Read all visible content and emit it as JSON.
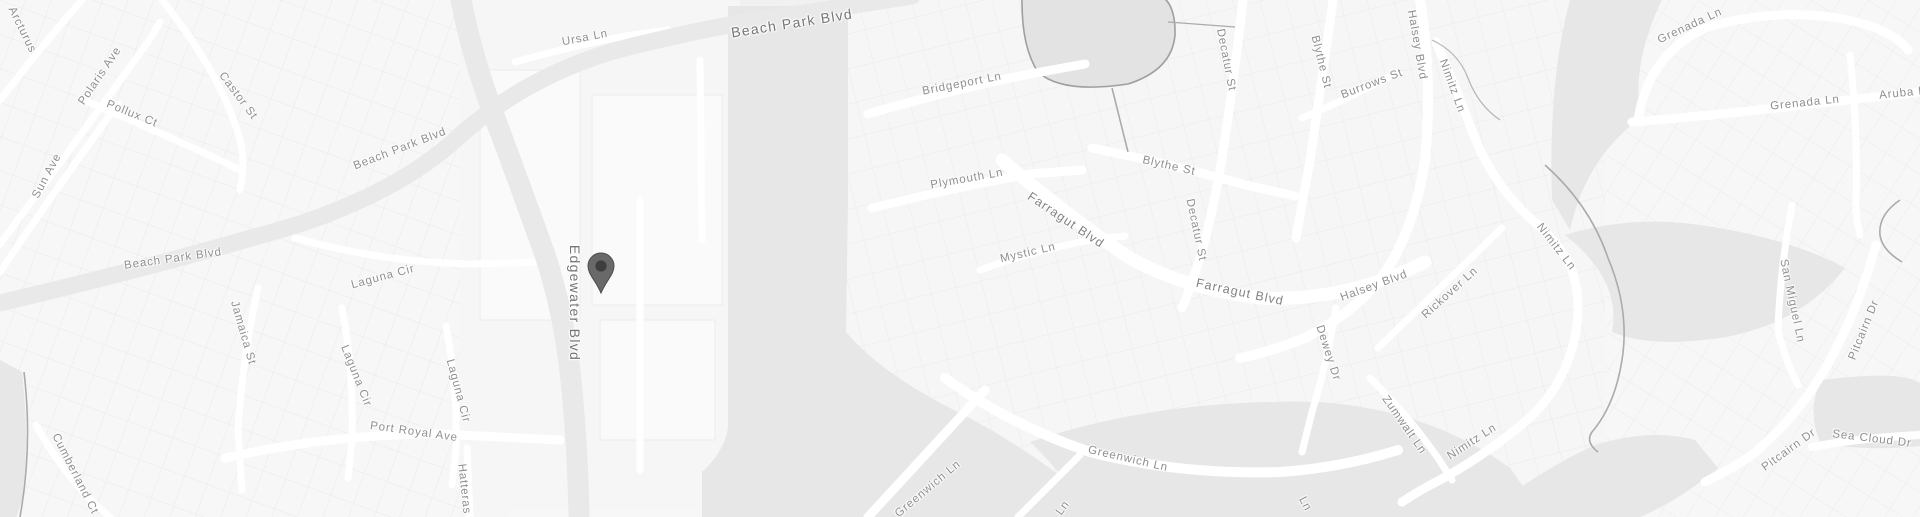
{
  "map": {
    "title": "Grayscale street map with location marker",
    "colors": {
      "land": "#f1f1f2",
      "parcel_fill": "#f8f8f9",
      "parcel_line": "#e9e9ea",
      "road_minor": "#ffffff",
      "road_major": "#e9e9ea",
      "water": "#e7e7e8",
      "pond": "#e3e3e4",
      "coastline": "#a9a9a9",
      "label": "#8f8f8f",
      "label_major": "#757575",
      "pin_body": "#696969",
      "pin_core": "#3e3e3e"
    },
    "pin": {
      "label": "dropped-pin",
      "tip_x": 601,
      "tip_y": 293
    },
    "labels": [
      {
        "text": "Arcturus",
        "x": 22,
        "y": 30,
        "rot": 64,
        "size": "sm"
      },
      {
        "text": "Polaris Ave",
        "x": 100,
        "y": 76,
        "rot": -56,
        "size": "sm"
      },
      {
        "text": "Pollux Ct",
        "x": 132,
        "y": 114,
        "rot": 22,
        "size": "sm"
      },
      {
        "text": "Castor St",
        "x": 238,
        "y": 96,
        "rot": 53,
        "size": "sm"
      },
      {
        "text": "Sun Ave",
        "x": 47,
        "y": 176,
        "rot": -62,
        "size": "sm"
      },
      {
        "text": "Beach Park Blvd",
        "x": 400,
        "y": 149,
        "rot": -21,
        "size": "sm"
      },
      {
        "text": "Beach Park Blvd",
        "x": 173,
        "y": 259,
        "rot": -8,
        "size": "sm"
      },
      {
        "text": "Beach Park Blvd",
        "x": 792,
        "y": 23,
        "rot": -9,
        "size": "lg"
      },
      {
        "text": "Ursa Ln",
        "x": 585,
        "y": 38,
        "rot": -11,
        "size": "sm"
      },
      {
        "text": "Edgewater Blvd",
        "x": 575,
        "y": 303,
        "rot": 90,
        "size": "lg"
      },
      {
        "text": "Laguna Cir",
        "x": 383,
        "y": 277,
        "rot": -15,
        "size": "sm"
      },
      {
        "text": "Jamaica St",
        "x": 243,
        "y": 333,
        "rot": 74,
        "size": "sm"
      },
      {
        "text": "Laguna Cir",
        "x": 356,
        "y": 376,
        "rot": 68,
        "size": "sm"
      },
      {
        "text": "Laguna Cir",
        "x": 458,
        "y": 391,
        "rot": 75,
        "size": "sm"
      },
      {
        "text": "Port Royal Ave",
        "x": 414,
        "y": 432,
        "rot": 8,
        "size": "sm"
      },
      {
        "text": "Cumberland Ct",
        "x": 75,
        "y": 474,
        "rot": 63,
        "size": "sm"
      },
      {
        "text": "Hatteras",
        "x": 464,
        "y": 489,
        "rot": 84,
        "size": "sm"
      },
      {
        "text": "Bridgeport Ln",
        "x": 962,
        "y": 84,
        "rot": -11,
        "size": "sm"
      },
      {
        "text": "Plymouth Ln",
        "x": 967,
        "y": 179,
        "rot": -10,
        "size": "sm"
      },
      {
        "text": "Blythe St",
        "x": 1169,
        "y": 166,
        "rot": 13,
        "size": "sm"
      },
      {
        "text": "Decatur St",
        "x": 1226,
        "y": 60,
        "rot": 79,
        "size": "sm"
      },
      {
        "text": "Blythe St",
        "x": 1321,
        "y": 62,
        "rot": 76,
        "size": "sm"
      },
      {
        "text": "Burrows St",
        "x": 1372,
        "y": 84,
        "rot": -21,
        "size": "sm"
      },
      {
        "text": "Halsey Blvd",
        "x": 1417,
        "y": 45,
        "rot": 80,
        "size": "sm"
      },
      {
        "text": "Nimitz Ln",
        "x": 1452,
        "y": 86,
        "rot": 70,
        "size": "sm"
      },
      {
        "text": "Farragut Blvd",
        "x": 1066,
        "y": 220,
        "rot": 34,
        "size": "md"
      },
      {
        "text": "Mystic Ln",
        "x": 1028,
        "y": 253,
        "rot": -13,
        "size": "sm"
      },
      {
        "text": "Decatur St",
        "x": 1196,
        "y": 230,
        "rot": 78,
        "size": "sm"
      },
      {
        "text": "Farragut Blvd",
        "x": 1240,
        "y": 292,
        "rot": 12,
        "size": "md"
      },
      {
        "text": "Halsey Blvd",
        "x": 1374,
        "y": 286,
        "rot": -20,
        "size": "sm"
      },
      {
        "text": "Rickover Ln",
        "x": 1450,
        "y": 293,
        "rot": -42,
        "size": "sm"
      },
      {
        "text": "Nimitz Ln",
        "x": 1556,
        "y": 247,
        "rot": 52,
        "size": "sm"
      },
      {
        "text": "Dewey Dr",
        "x": 1328,
        "y": 353,
        "rot": 72,
        "size": "sm"
      },
      {
        "text": "Zumwalt Ln",
        "x": 1404,
        "y": 425,
        "rot": 55,
        "size": "sm"
      },
      {
        "text": "Nimitz Ln",
        "x": 1472,
        "y": 442,
        "rot": -33,
        "size": "sm"
      },
      {
        "text": "Greenwich Ln",
        "x": 1128,
        "y": 459,
        "rot": 13,
        "size": "sm"
      },
      {
        "text": "Greenwich Ln",
        "x": 928,
        "y": 489,
        "rot": -40,
        "size": "sm"
      },
      {
        "text": "Ln",
        "x": 1063,
        "y": 508,
        "rot": -55,
        "size": "sm"
      },
      {
        "text": "Ln",
        "x": 1305,
        "y": 504,
        "rot": 62,
        "size": "sm"
      },
      {
        "text": "Grenada Ln",
        "x": 1690,
        "y": 26,
        "rot": -25,
        "size": "sm"
      },
      {
        "text": "Grenada Ln",
        "x": 1805,
        "y": 103,
        "rot": -6,
        "size": "sm"
      },
      {
        "text": "Aruba Ln",
        "x": 1906,
        "y": 93,
        "rot": -6,
        "size": "sm"
      },
      {
        "text": "San Miguel Ln",
        "x": 1792,
        "y": 301,
        "rot": 78,
        "size": "sm"
      },
      {
        "text": "Pitcairn Dr",
        "x": 1864,
        "y": 330,
        "rot": -68,
        "size": "sm"
      },
      {
        "text": "Pitcairn Dr",
        "x": 1789,
        "y": 450,
        "rot": -36,
        "size": "sm"
      },
      {
        "text": "Sea Cloud Dr",
        "x": 1872,
        "y": 439,
        "rot": 7,
        "size": "sm"
      }
    ]
  }
}
